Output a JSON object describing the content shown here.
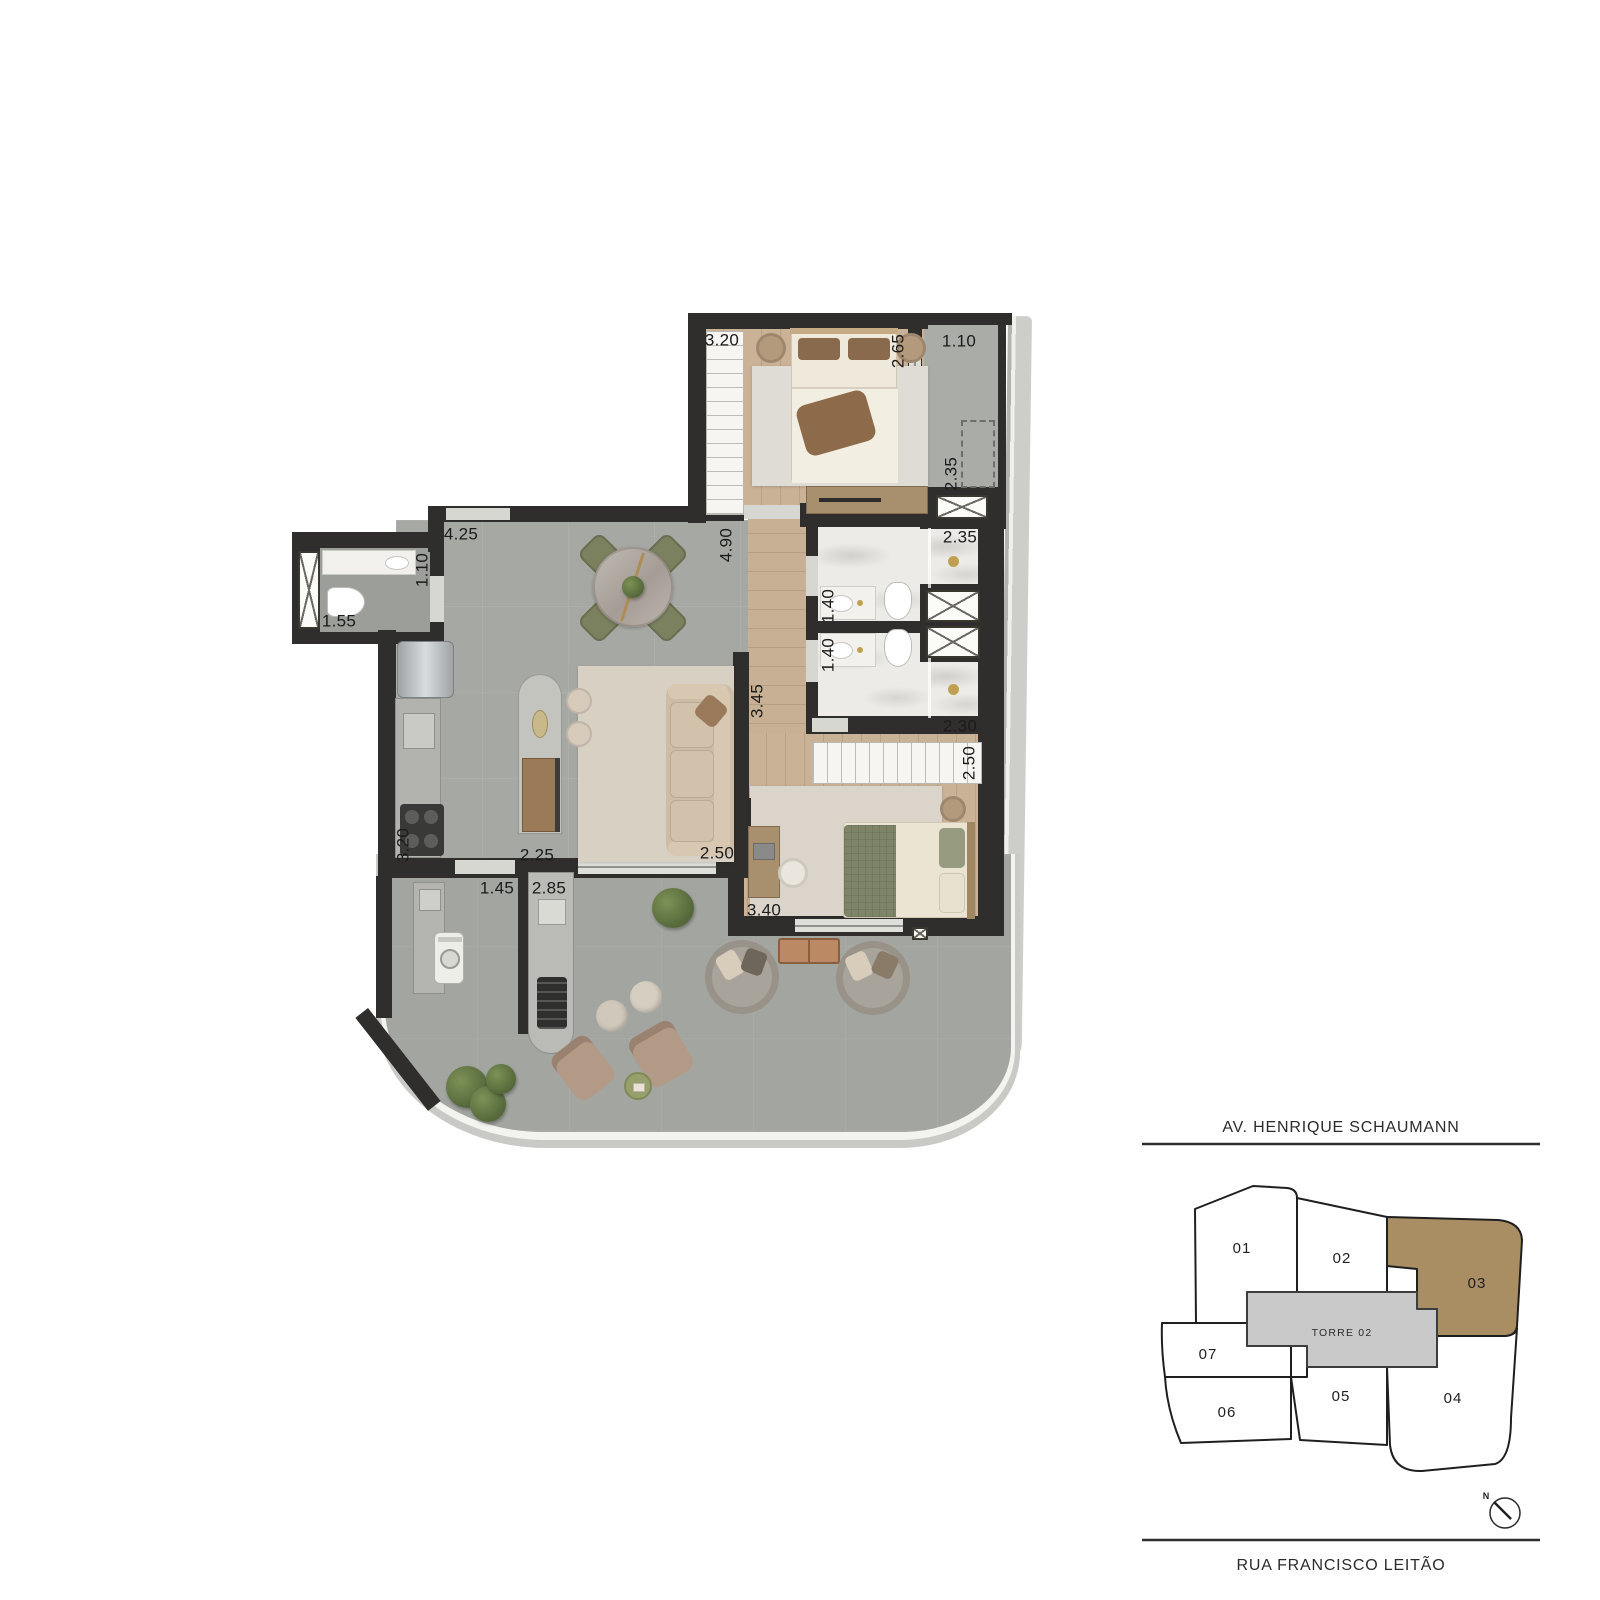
{
  "plan": {
    "dimensions": [
      "3.20",
      "2.65",
      "1.10",
      "2.35",
      "2.35",
      "1.40",
      "1.40",
      "2.30",
      "2.50",
      "3.40",
      "4.25",
      "4.90",
      "1.10",
      "1.55",
      "3.45",
      "2.25",
      "2.50",
      "3.20",
      "1.45",
      "2.85"
    ]
  },
  "keyplan": {
    "street_top": "AV. HENRIQUE SCHAUMANN",
    "street_bottom": "RUA FRANCISCO LEITÃO",
    "tower_label": "TORRE 02",
    "units": [
      "01",
      "02",
      "03",
      "04",
      "05",
      "06",
      "07"
    ],
    "highlighted_unit": "03",
    "highlight_color": "#a98e63",
    "tower_fill": "#c9c9c9",
    "north_label": "N"
  },
  "colors": {
    "wall": "#2f2e2c",
    "wood_floor": "#c9b296",
    "stone_floor": "#a6a8a4",
    "terrace_floor": "#a3a5a1",
    "marble_floor": "#edebe7",
    "deck_edge": "#c9cac5",
    "accent_gold": "#bfa050",
    "dining_chair_green": "#7b805f"
  }
}
